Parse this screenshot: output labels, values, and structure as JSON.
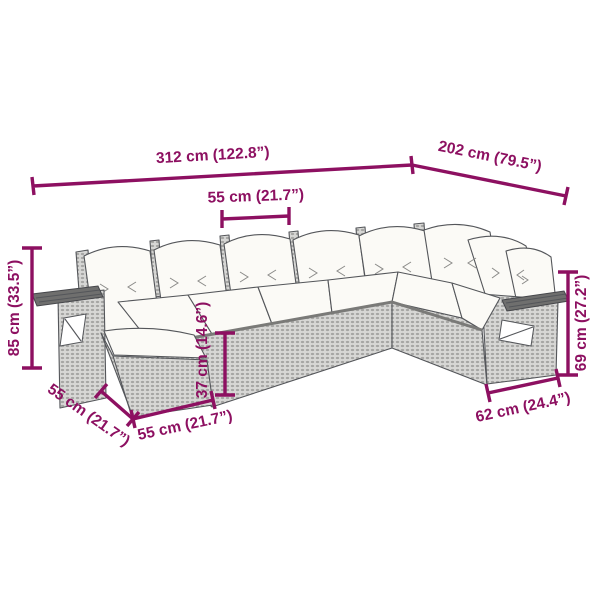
{
  "diagram": {
    "type": "product-dimension-diagram",
    "subject": "L-shaped rattan garden sofa set with cushions, trays and ottoman",
    "dims": {
      "d312": "312 cm (122.8”)",
      "d202": "202 cm (79.5”)",
      "d55_top": "55 cm (21.7”)",
      "d85": "85 cm (33.5”)",
      "d37": "37 cm (14.6”)",
      "d69": "69 cm (27.2”)",
      "d55_diag": "55 cm (21.7”)",
      "d55_bottom": "55 cm (21.7”)",
      "d62": "62 cm (24.4”)"
    },
    "colors": {
      "dimension": "#8d1061",
      "line_art": "#54565a",
      "wicker_fill": "#d7d7d5",
      "wicker_dot": "#a6a6a4",
      "cushion": "#fbfaf6",
      "background": "#ffffff"
    }
  }
}
